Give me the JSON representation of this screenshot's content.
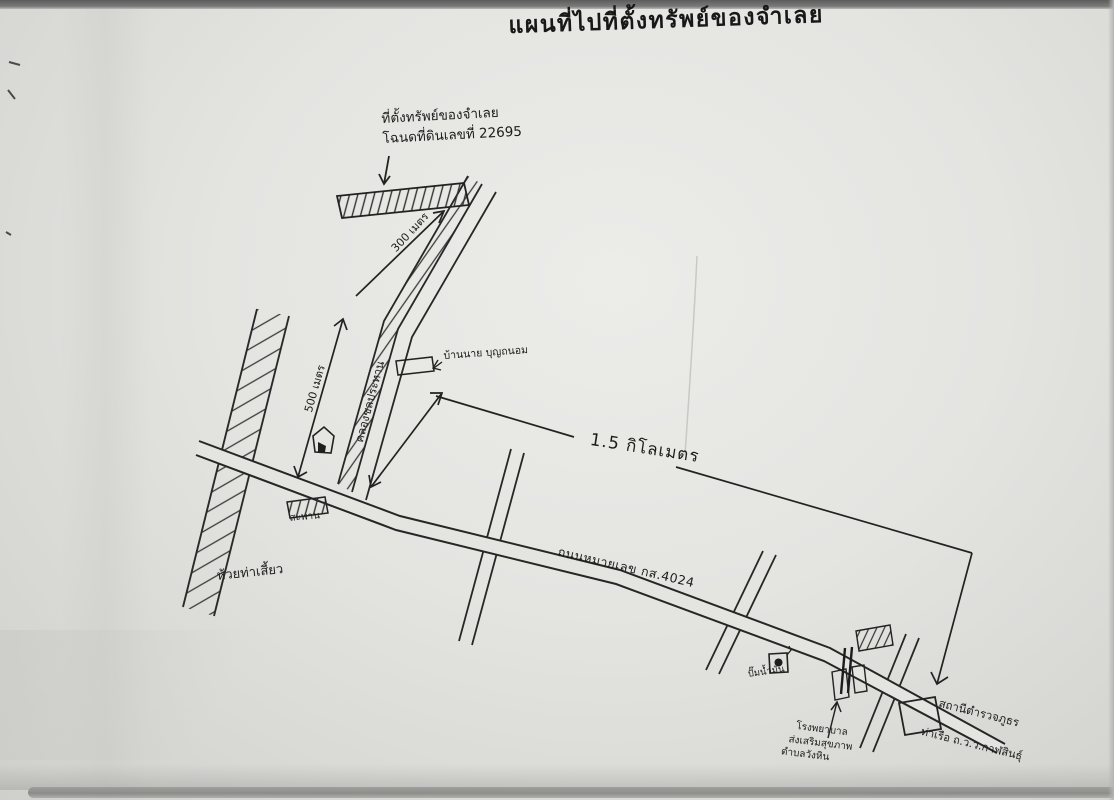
{
  "document": {
    "title": "แผนที่ไปที่ตั้งทรัพย์ของจำเลย"
  },
  "property_note": {
    "line1": "ที่ตั้งทรัพย์ของจำเลย",
    "line2": "โฉนดที่ดินเลขที่ 22695"
  },
  "labels": {
    "distance_300m": "300 เมตร",
    "distance_500m": "500 เมตร",
    "distance_1_5km": "1.5 กิโลเมตร",
    "canal_road": "คลองชลประทาน",
    "highway": "ถนนหมายเลข กส.4024",
    "house": "บ้านนาย บุญถนอม",
    "bridge": "สะพาน",
    "creek": "ห้วยท่าเสี้ยว",
    "gas_station": "ปั๊มน้ำมัน",
    "hospital_line1": "โรงพยาบาล",
    "hospital_line2": "ส่งเสริมสุขภาพ",
    "hospital_line3": "ตำบลวังหิน",
    "police_line1": "สถานีตำรวจภูธร",
    "police_line2": "ท่าเรือ ถ.ว.ว.กาฬสินธุ์"
  }
}
